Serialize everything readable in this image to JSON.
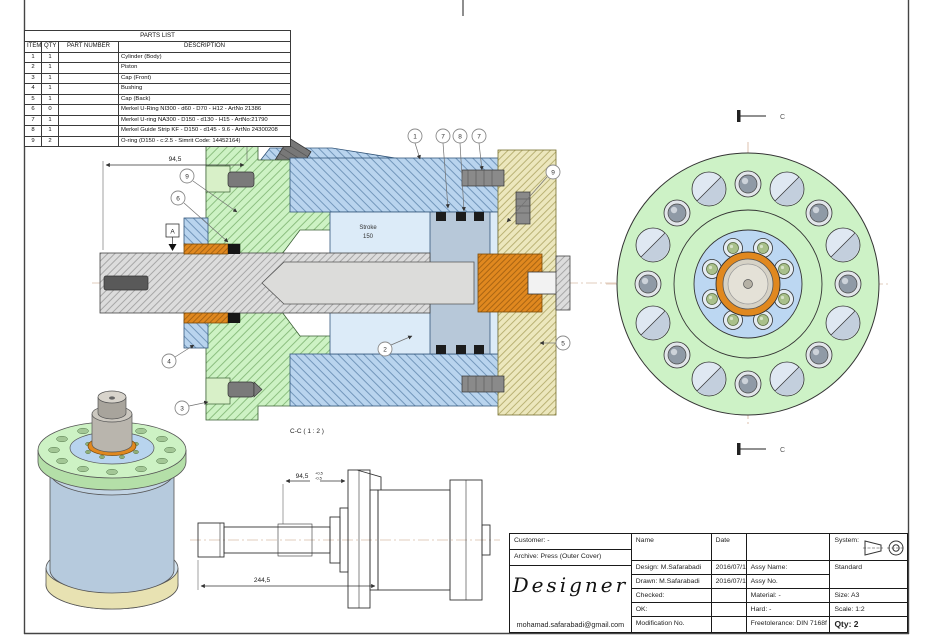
{
  "parts_list": {
    "title": "PARTS LIST",
    "columns": [
      "ITEM",
      "QTY",
      "PART NUMBER",
      "DESCRIPTION"
    ],
    "rows": [
      {
        "item": "1",
        "qty": "1",
        "part_number": "",
        "description": "Cylinder (Body)"
      },
      {
        "item": "2",
        "qty": "1",
        "part_number": "",
        "description": "Piston"
      },
      {
        "item": "3",
        "qty": "1",
        "part_number": "",
        "description": "Cap (Front)"
      },
      {
        "item": "4",
        "qty": "1",
        "part_number": "",
        "description": "Bushing"
      },
      {
        "item": "5",
        "qty": "1",
        "part_number": "",
        "description": "Cap (Back)"
      },
      {
        "item": "6",
        "qty": "0",
        "part_number": "",
        "description": "Merkel U-Ring NI300 - d60 - D70 - H12 - ArtNo 21386"
      },
      {
        "item": "7",
        "qty": "1",
        "part_number": "",
        "description": "Merkel U-ring NA300 - D150 - d130 - H15 - ArtNo:21790"
      },
      {
        "item": "8",
        "qty": "1",
        "part_number": "",
        "description": "Merkel Guide Strip KF - D150 - d145 - 9.6 - ArtNo 24300208"
      },
      {
        "item": "9",
        "qty": "2",
        "part_number": "",
        "description": "O-ring (D150 - c:2.5 - Simrit Code: 14452164)"
      }
    ]
  },
  "main_view": {
    "label": "C-C ( 1 : 2 )",
    "dim_width": "94,5",
    "stroke_label": "Stroke",
    "stroke_value": "150",
    "datum": "A",
    "balloons": [
      "9",
      "6",
      "1",
      "7",
      "8",
      "7",
      "9",
      "5",
      "2",
      "4",
      "3"
    ]
  },
  "end_view": {
    "cut_marker_top": "C",
    "cut_marker_bottom": "C"
  },
  "outline_view": {
    "dim_rod": "94,5",
    "dim_rod_tol_upper": "+0,5",
    "dim_rod_tol_lower": "-0,5",
    "dim_overall": "244,5"
  },
  "title_block": {
    "customer": "Customer: -",
    "archive": "Archive: Press (Outer Cover)",
    "brand": "Designer",
    "email": "mohamad.safarabadi@gmail.com",
    "name_header": "Name",
    "date_header": "Date",
    "design": "Design:  M.Safarabadi",
    "design_date": "2016/07/16",
    "drawn": "Drawn:  M.Safarabadi",
    "drawn_date": "2016/07/16",
    "checked": "Checked:",
    "ok": "OK:",
    "modification": "Modification No.",
    "assy_name": "Assy Name:",
    "assy_no": "Assy No.",
    "material": "Material:   -",
    "hard": "Hard:   -",
    "freetolerance": "Freetolerance:  DIN 7168f",
    "system": "System:",
    "standard": "Standard",
    "size": "Size: A3",
    "scale": "Scale: 1:2",
    "qty": "Qty: 2"
  },
  "colors": {
    "cap_front_green": "#cdf2c4",
    "cylinder_blue": "#b9d4ee",
    "bore_blue": "#dcebf8",
    "bushing_orange": "#e0881f",
    "cap_back_beige": "#ece7bd",
    "piston_steel": "#b7c8d9",
    "rod_gray": "#dcdcdc"
  }
}
